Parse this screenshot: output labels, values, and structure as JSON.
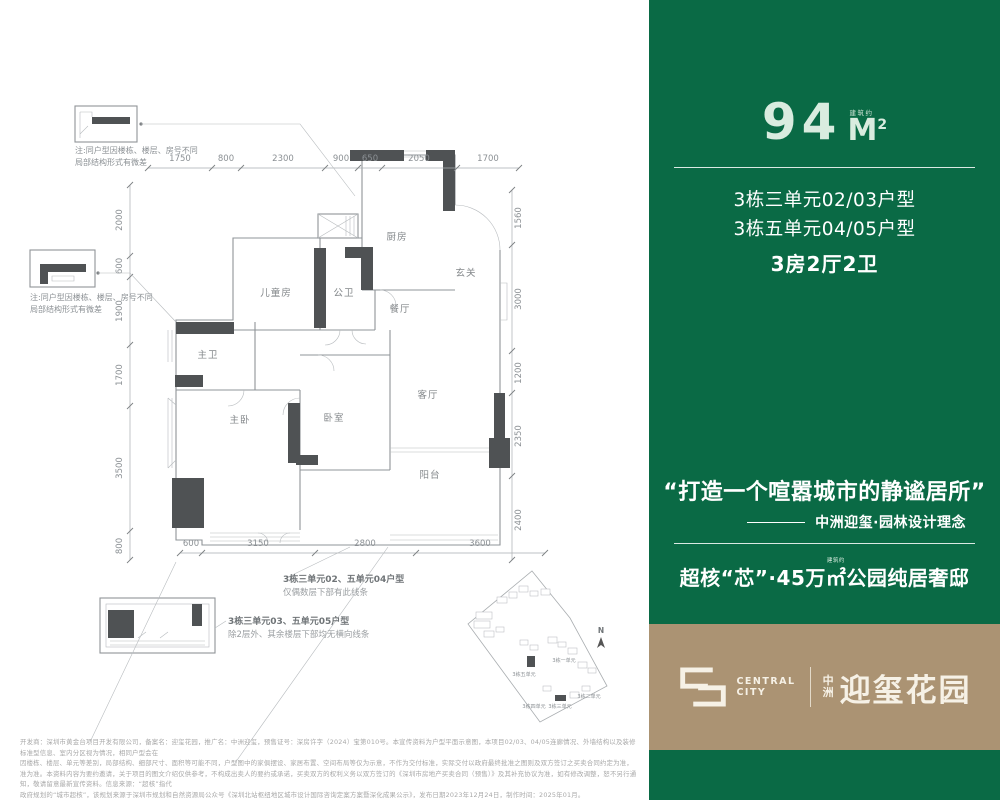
{
  "right_panel": {
    "bg_color": "#0a6a45",
    "area_value": "94",
    "area_approx": "建筑约",
    "area_unit": "M",
    "area_sup": "2",
    "unit_line1": "3栋三单元02/03户型",
    "unit_line2": "3栋五单元04/05户型",
    "layout": "3房2厅2卫",
    "quote": "“打造一个喧嚣城市的静谧居所”",
    "attribution": "中洲迎玺·园林设计理念",
    "slogan_pre": "超核“芯”·45万",
    "slogan_sup": "建筑约",
    "slogan_unit": "㎡",
    "slogan_post": "公园纯居奢邸"
  },
  "brand_bar": {
    "bg_color": "#ab9373",
    "logo_line1": "CENTRAL",
    "logo_line2": "CITY",
    "cn_top": "中",
    "cn_bottom": "洲",
    "name": "迎玺花园"
  },
  "floor_plan": {
    "rooms": {
      "kitchen": "厨房",
      "entry": "玄关",
      "dining": "餐厅",
      "bath": "公卫",
      "kids": "儿童房",
      "master_bath": "主卫",
      "master_bed": "主卧",
      "bedroom": "卧室",
      "living": "客厅",
      "balcony": "阳台"
    },
    "dims_top": [
      "1750",
      "800",
      "2300",
      "900",
      "650",
      "2050",
      "1700"
    ],
    "dims_left": [
      "2000",
      "600",
      "1900",
      "1700",
      "3500",
      "800"
    ],
    "dims_right": [
      "1560",
      "3000",
      "1200",
      "2350",
      "2400"
    ],
    "dims_bottom": [
      "600",
      "3150",
      "2800",
      "3600"
    ],
    "note1_line1": "注:同户型因楼栋、楼层、房号不同",
    "note1_line2": "局部结构形式有微差",
    "note2_line1": "注:同户型因楼栋、楼层、房号不同",
    "note2_line2": "局部结构形式有微差",
    "anno1_title": "3栋三单元02、五单元04户型",
    "anno1_sub": "仅偶数层下部有此线条",
    "anno2_title": "3栋三单元03、五单元05户型",
    "anno2_sub": "除2层外、其余楼层下部均无横向线条",
    "sitemap": {
      "north": "N",
      "labels": [
        "3栋五单元",
        "3栋一单元",
        "3栋二单元",
        "3栋四单元",
        "3栋三单元"
      ]
    }
  },
  "disclaimer": {
    "line1": "开发商：深圳市黄金台项目开发有限公司，备案名：迎玺花园，推广名：中洲迎玺，预售证号：深房许字（2024）宝第010号。本宣传资料为户型平面示意图，本项目02/03、04/05连廊情况、外墙结构以及装修标准型信息、室内分区视为情况，相同户型会在",
    "line2": "因楼栋、楼层、单元等差别，局部结构、细部尺寸、面积等可能不同，户型图中的家俱摆设、家居布置、空间布局等仅为示意，不作为交付标准，实际交付以政府最终批准之图则及双方签订之买卖合同约定为准，",
    "line3": "准为准。本资料内容为要约邀请，关于项目的图文介绍仅供参考，不构成出卖人的要约或承诺，买卖双方的权利义务以双方签订的《深圳市房地产买卖合同（预售）》及其补充协议为准，如有修改调整，恕不另行通知，敬请留意最新宣传资料。信息来源：“超核”指代",
    "line4": "政府规划的“城市超核”，该规划来源于深圳市规划和自然资源局公众号《深圳北站枢纽地区城市设计国际咨询定案方案暨深化成果公示》，发布日期2023年12月24日，制作时间：2025年01月。"
  }
}
